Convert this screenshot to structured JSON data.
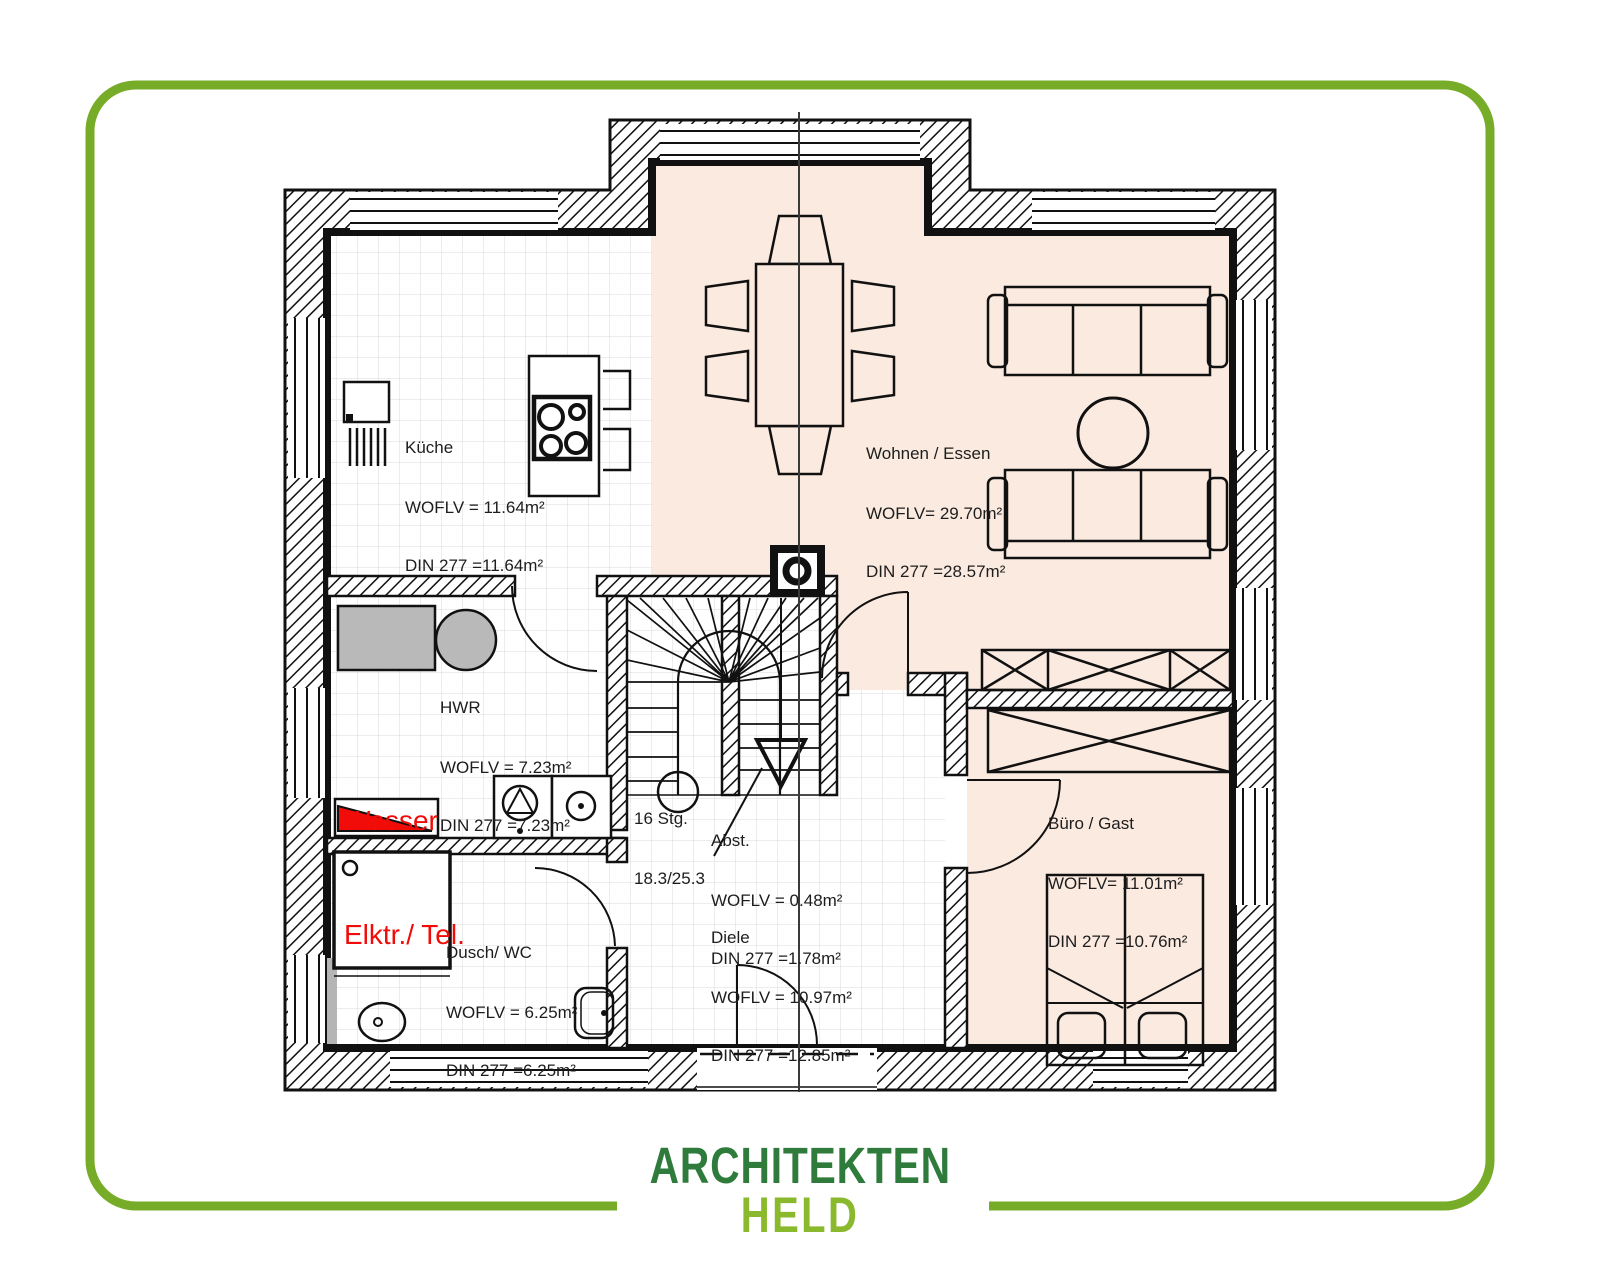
{
  "logo": {
    "line1": "ARCHITEKTEN",
    "line2": "HELD"
  },
  "plan": {
    "rooms": {
      "kueche": {
        "name": "Küche",
        "woflv": "WOFLV = 11.64m²",
        "din": "DIN 277 =11.64m²"
      },
      "wohnen_essen": {
        "name": "Wohnen / Essen",
        "woflv": "WOFLV= 29.70m²",
        "din": "DIN 277 =28.57m²"
      },
      "hwr": {
        "name": "HWR",
        "woflv": "WOFLV = 7.23m²",
        "din": "DIN 277 =7.23m²"
      },
      "abstellraum": {
        "name": "Abst.",
        "woflv": "WOFLV = 0.48m²",
        "din": "DIN 277 =1.78m²"
      },
      "buero_gast": {
        "name": "Büro / Gast",
        "woflv": "WOFLV= 11.01m²",
        "din": "DIN 277 =10.76m²"
      },
      "diele": {
        "name": "Diele",
        "woflv": "WOFLV = 10.97m²",
        "din": "DIN 277 =12.85m²"
      },
      "dusch_wc": {
        "name": "Dusch/ WC",
        "woflv": "WOFLV = 6.25m²",
        "din": "DIN 277 =6.25m²"
      }
    },
    "stairs": {
      "line1": "16 Stg.",
      "line2": "18.3/25.3"
    },
    "utilities": {
      "line1": "Wasser",
      "line2": "Elktr./ Tel."
    }
  },
  "colors": {
    "frame_green": "#77ac29",
    "logo_dark_green": "#2e7b3c",
    "logo_light_green": "#8ab92e",
    "room_tint_pink": "#fbeae0",
    "utility_red": "#f10c09",
    "appliance_gray": "#b9b9b9"
  }
}
